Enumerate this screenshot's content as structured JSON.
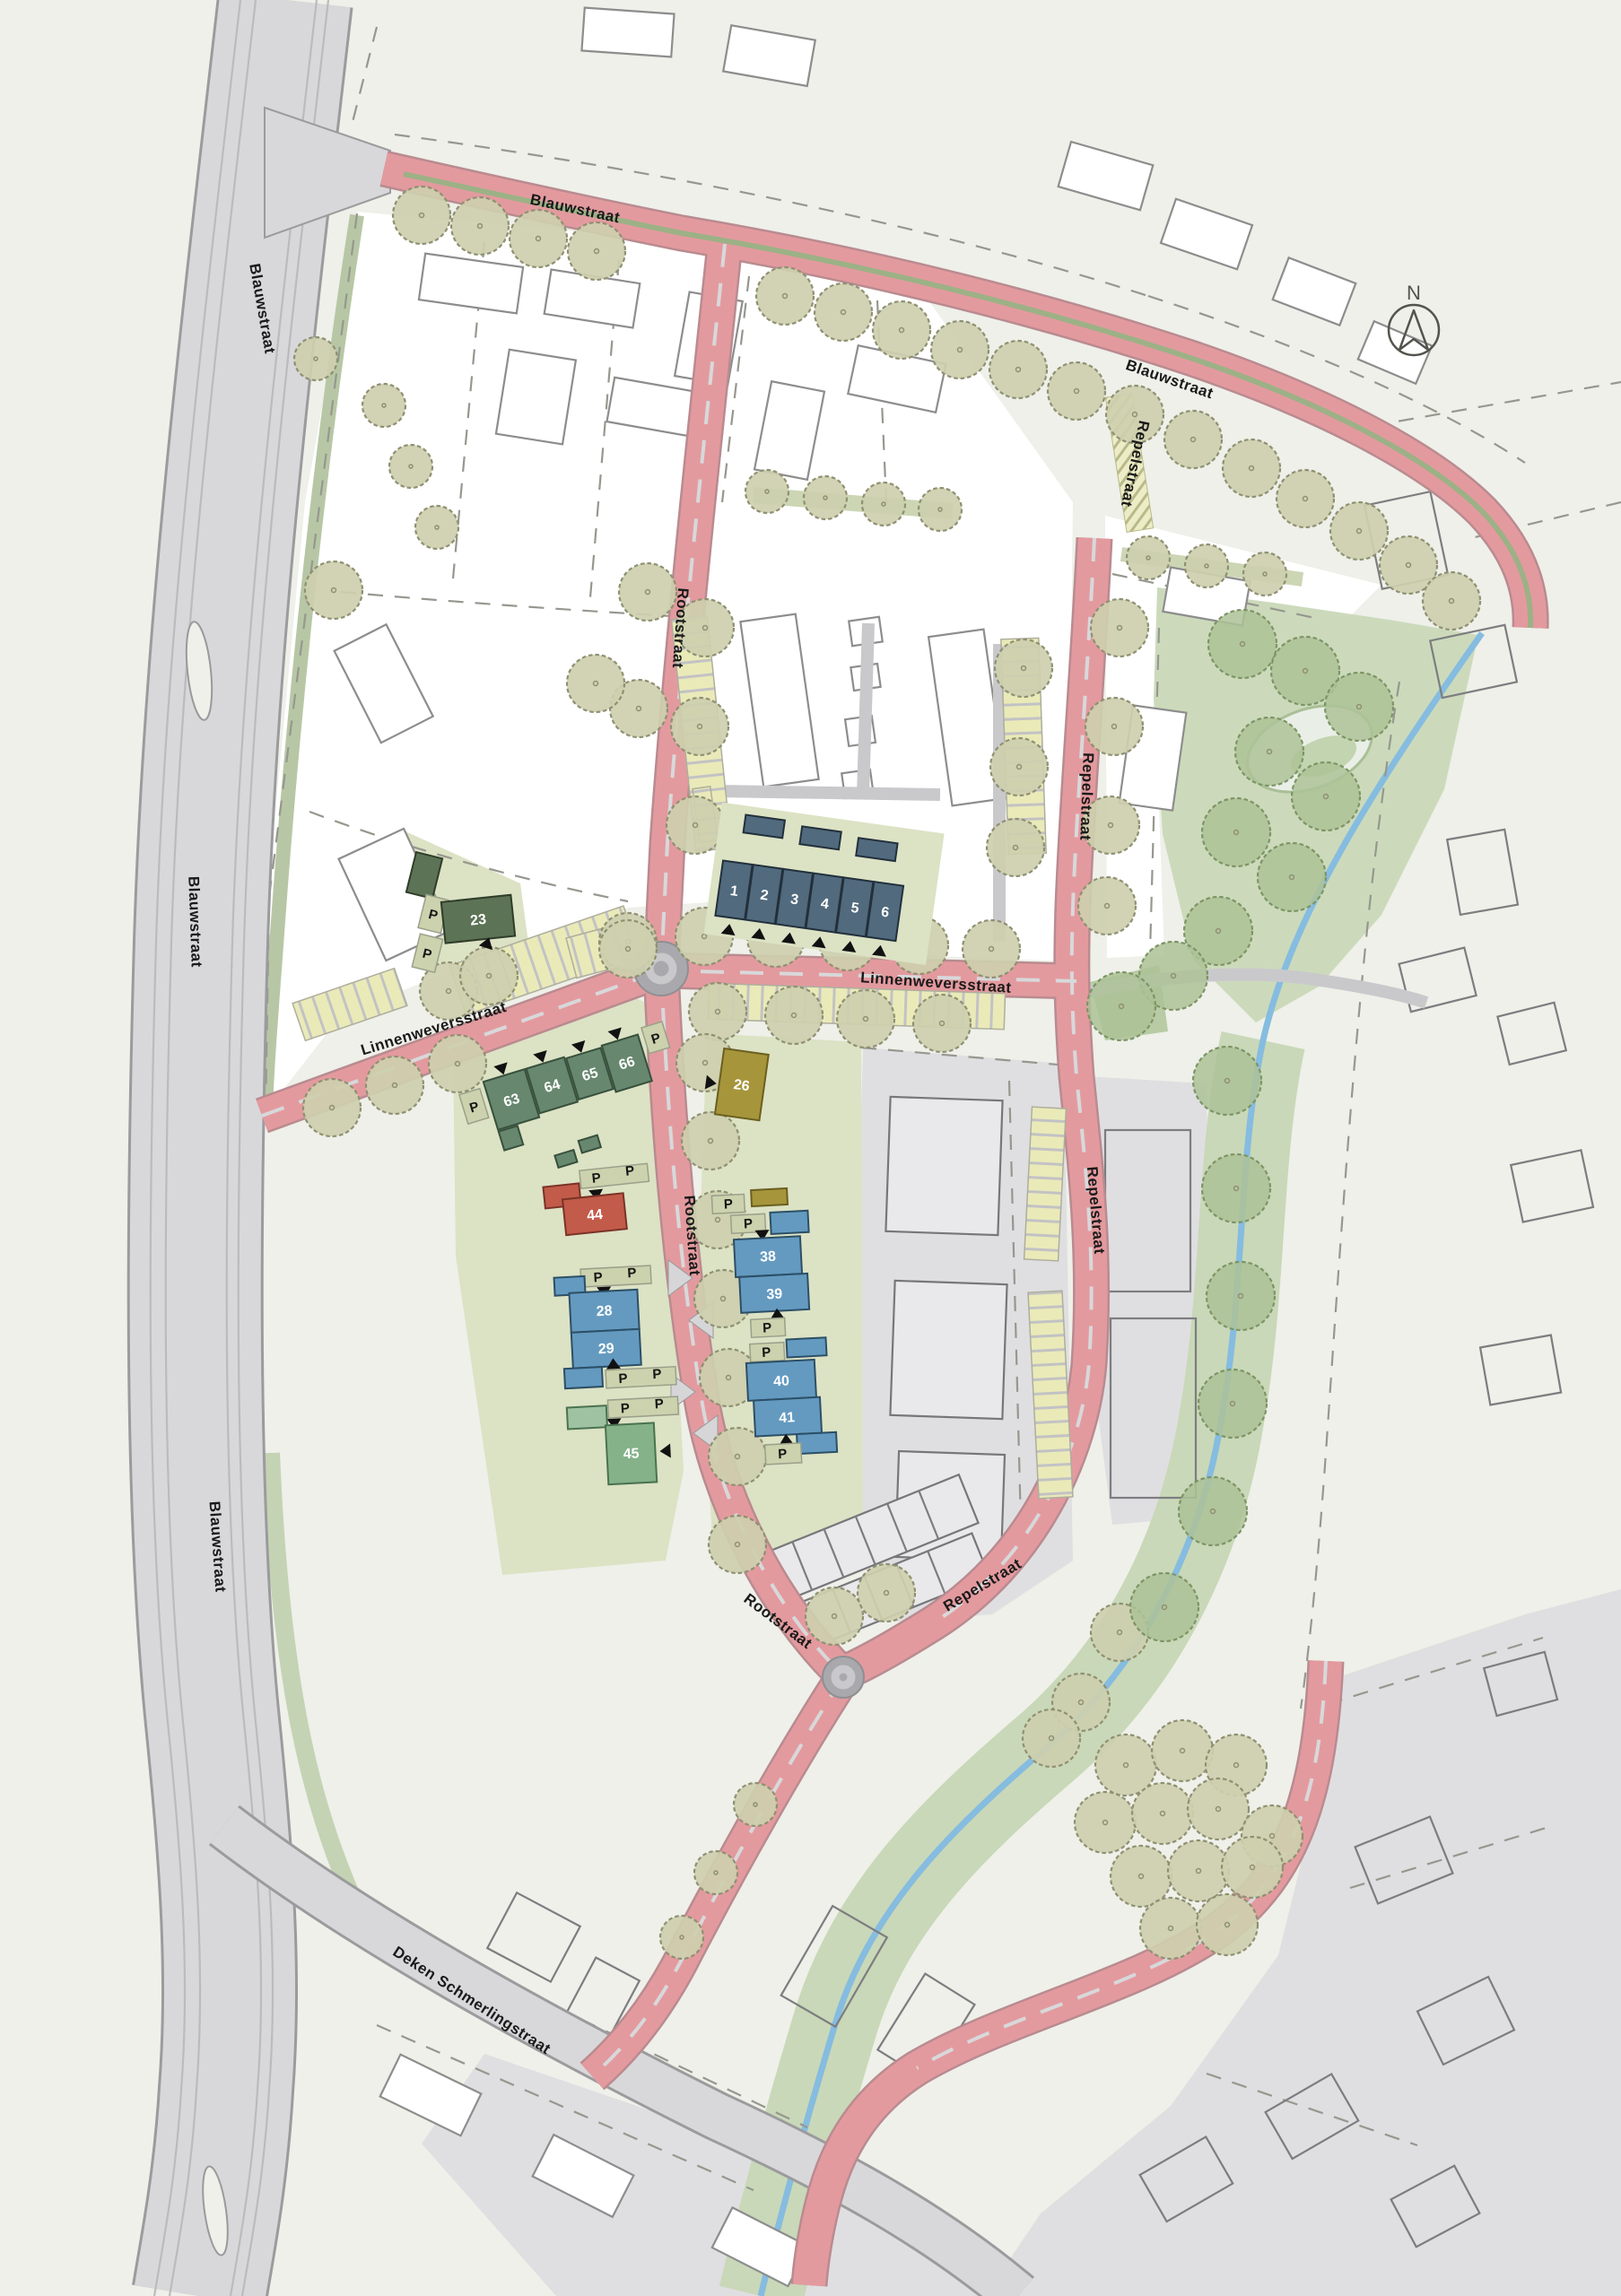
{
  "labels": {
    "north": "N",
    "parking": "P"
  },
  "streets": {
    "blauwstraat": "Blauwstraat",
    "rootstraat": "Rootstraat",
    "repelstraat": "Repelstraat",
    "linnenweversstraat": "Linnenweversstraat",
    "deken_schmerlingstraat": "Deken Schmerlingstraat"
  },
  "blocks": {
    "b1": "1",
    "b2": "2",
    "b3": "3",
    "b4": "4",
    "b5": "5",
    "b6": "6",
    "b23": "23",
    "b26": "26",
    "b28": "28",
    "b29": "29",
    "b38": "38",
    "b39": "39",
    "b40": "40",
    "b41": "41",
    "b44": "44",
    "b45": "45",
    "b63": "63",
    "b64": "64",
    "b65": "65",
    "b66": "66"
  },
  "colors": {
    "background": "#eef0e9",
    "white_parcel": "#ffffff",
    "road_pink": "#e39a9e",
    "road_pink_edge": "#b98b90",
    "road_gray": "#d8d8da",
    "road_gray_edge": "#9b9b9d",
    "median_green": "#9cb186",
    "center_line": "#d8d8da",
    "roundabout_gray": "#a9a9ad",
    "parking_yellow": "#eaeab9",
    "parcel_green": "#dce2c4",
    "park_green": "#ccdabb",
    "corridor_green": "#c9d8b8",
    "stream_blue": "#85bce0",
    "tree_fill": "#cdcfae",
    "tree_stroke": "#8f9072",
    "tree_dark_fill": "#adc297",
    "tree_dark_stroke": "#7d9465",
    "block_darkblue": "#516a7d",
    "block_blue": "#649ac0",
    "block_green_dark": "#5c7355",
    "block_green": "#67876f",
    "block_light_green": "#85b289",
    "block_red": "#c25b49",
    "block_olive": "#a6953b",
    "existing_gray": "#dfdfe1",
    "label_black": "#1a1a1a"
  }
}
